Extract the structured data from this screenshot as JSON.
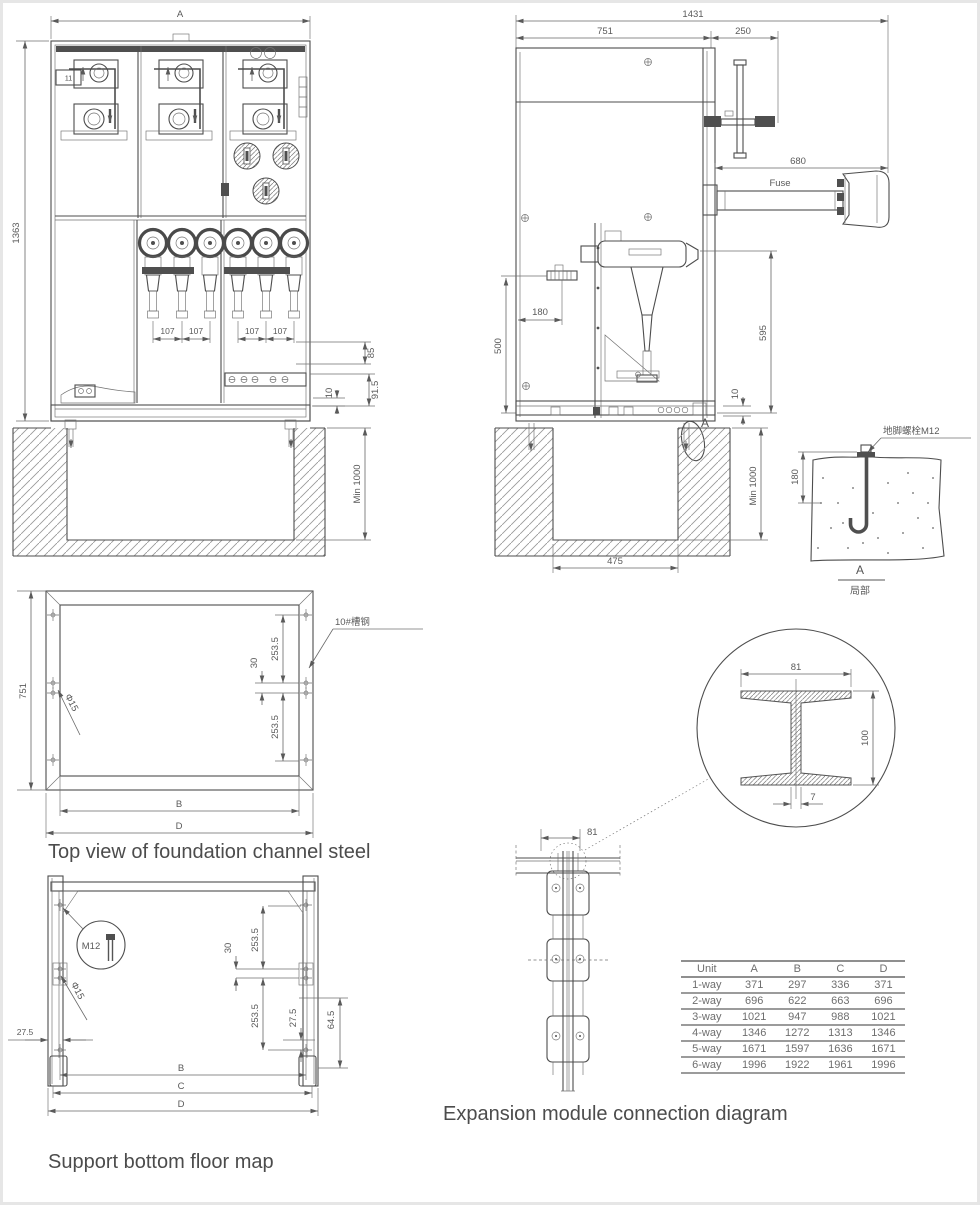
{
  "captions": {
    "channel": "Top view of foundation channel steel",
    "support": "Support bottom floor map",
    "expansion": "Expansion module connection diagram"
  },
  "front_view": {
    "dim_width": "A",
    "dim_height": "1363",
    "dim_pitch": "107",
    "dim_85": "85",
    "dim_91_5": "91.5",
    "dim_10": "10",
    "dim_pit_depth": "Min 1000",
    "nameplate": "11"
  },
  "side_view": {
    "dim_total_width": "1431",
    "dim_body_width": "751",
    "dim_handle": "250",
    "dim_fuse": "680",
    "fuse_label": "Fuse",
    "dim_595": "595",
    "dim_500": "500",
    "dim_180": "180",
    "dim_10": "10",
    "dim_pit_depth": "Min 1000",
    "dim_pit_width": "475",
    "detail_mark": "A"
  },
  "anchor_detail": {
    "label": "地脚螺栓M12",
    "dim_depth": "180",
    "mark": "A",
    "mark_caption": "局部"
  },
  "channel_view": {
    "dim_depth": "751",
    "hole": "Φ15",
    "steel": "10#槽钢",
    "dim_30": "30",
    "dim_253_5": "253.5",
    "dim_b": "B",
    "dim_d": "D"
  },
  "support_view": {
    "bolt": "M12",
    "hole": "Φ15",
    "dim_27_5": "27.5",
    "dim_30": "30",
    "dim_253_5": "253.5",
    "dim_64_5": "64.5",
    "dim_b": "B",
    "dim_c": "C",
    "dim_d": "D"
  },
  "expansion_view": {
    "dim_81": "81",
    "detail_width": "81",
    "detail_height": "100",
    "detail_web": "7"
  },
  "size_table": {
    "headers": [
      "Unit",
      "A",
      "B",
      "C",
      "D"
    ],
    "rows": [
      [
        "1-way",
        "371",
        "297",
        "336",
        "371"
      ],
      [
        "2-way",
        "696",
        "622",
        "663",
        "696"
      ],
      [
        "3-way",
        "1021",
        "947",
        "988",
        "1021"
      ],
      [
        "4-way",
        "1346",
        "1272",
        "1313",
        "1346"
      ],
      [
        "5-way",
        "1671",
        "1597",
        "1636",
        "1671"
      ],
      [
        "6-way",
        "1996",
        "1922",
        "1961",
        "1996"
      ]
    ]
  }
}
